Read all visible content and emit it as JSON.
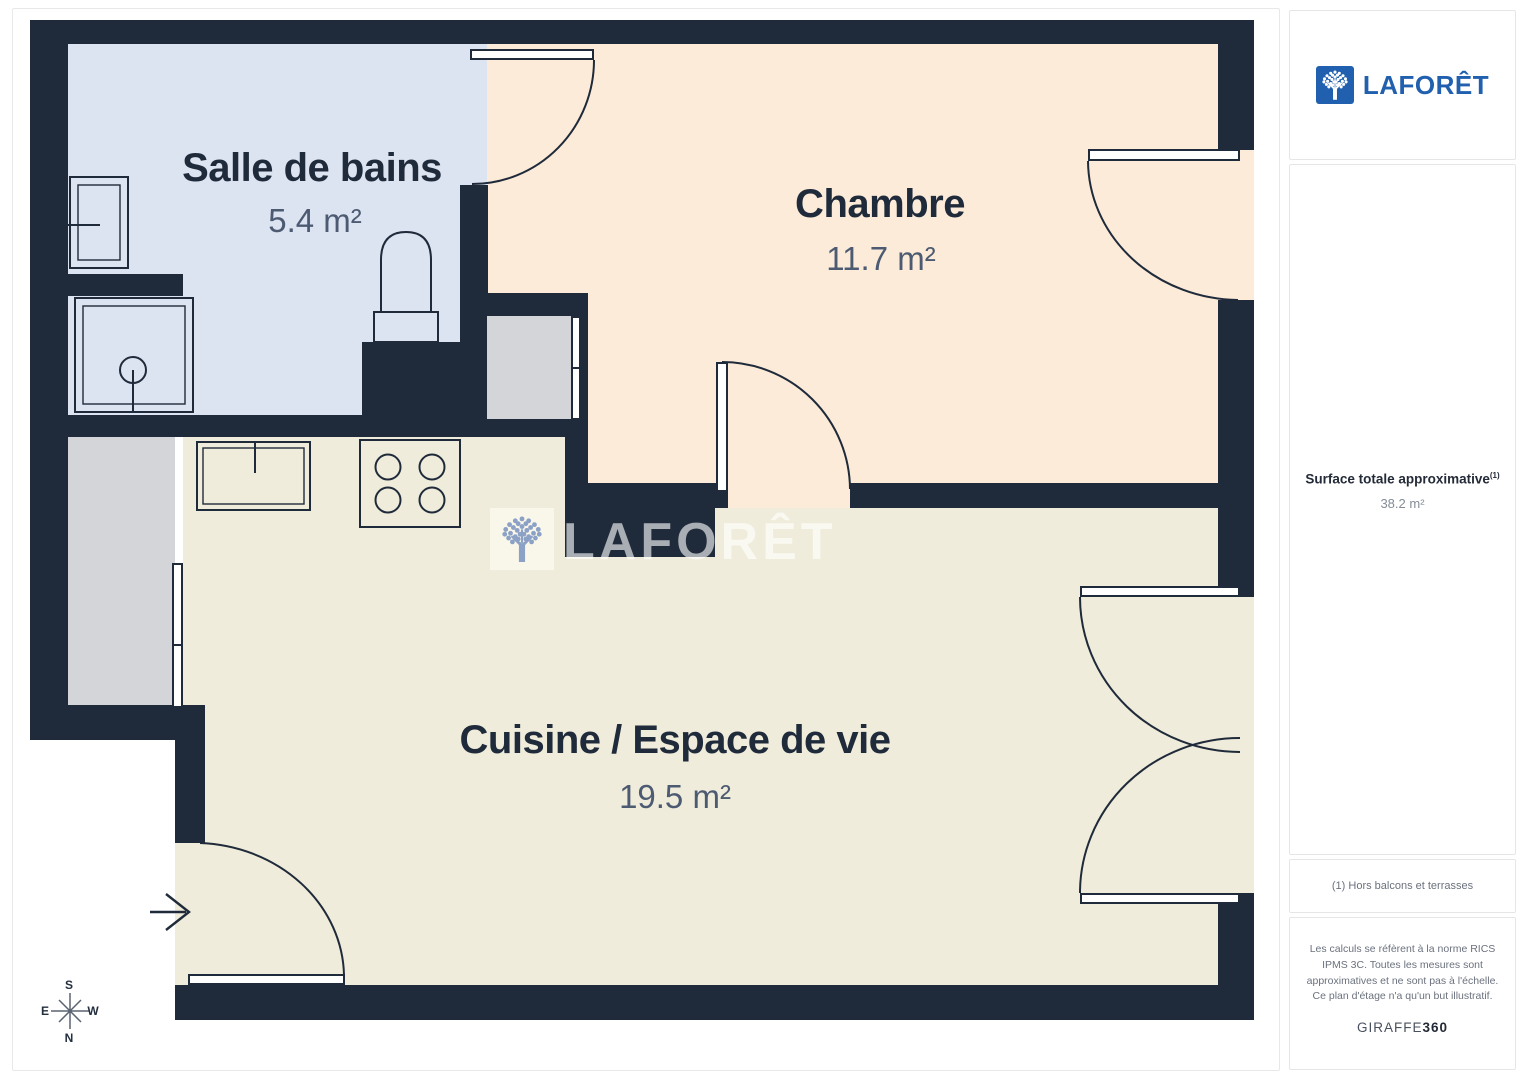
{
  "plan": {
    "rooms": [
      {
        "name": "Salle de bains",
        "area": "5.4 m²"
      },
      {
        "name": "Chambre",
        "area": "11.7 m²"
      },
      {
        "name": "Cuisine / Espace de vie",
        "area": "19.5 m²"
      }
    ],
    "compass": {
      "n": "N",
      "s": "S",
      "e": "E",
      "w": "W"
    },
    "watermark_text": "LAFORÊT",
    "colors": {
      "wall": "#1f2a3a",
      "bathroom_floor": "#dce3f1",
      "bedroom_floor": "#fcebd9",
      "living_floor": "#f0ecdb",
      "brand_blue": "#2160ae"
    }
  },
  "sidebar": {
    "logo_text": "LAFORÊT",
    "surface_label": "Surface totale approximative",
    "surface_sup": "(1)",
    "surface_value": "38.2 m²",
    "footnote": "(1) Hors balcons et terrasses",
    "disclaimer": "Les calculs se réfèrent à la norme RICS IPMS 3C. Toutes les mesures sont approximatives et ne sont pas à l'échelle. Ce plan d'étage n'a qu'un but illustratif.",
    "brand_name": "GIRAFFE",
    "brand_number": "360"
  }
}
